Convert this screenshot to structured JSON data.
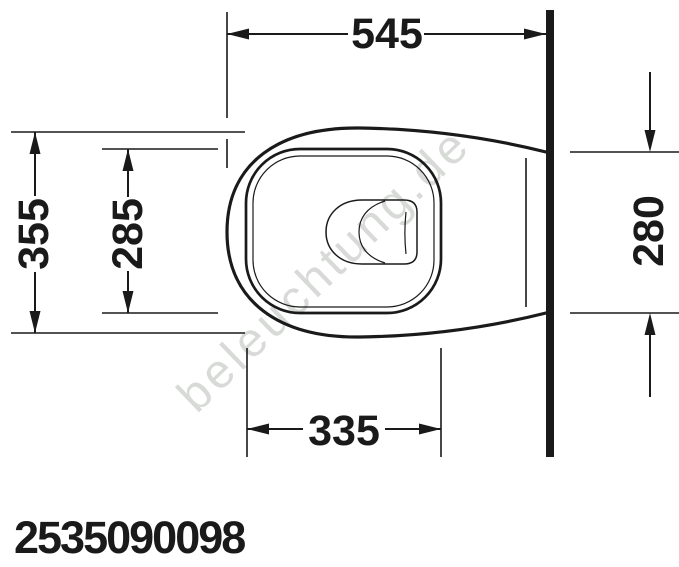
{
  "drawing": {
    "title": "wall-hung-toilet-top-view-technical-drawing",
    "watermark": "beleuchtung.de",
    "product_code": "2535090098",
    "dimensions": {
      "depth_total": "545",
      "width_total": "355",
      "seat_inner_width": "285",
      "rear_width": "280",
      "seat_inner_depth": "335"
    },
    "colors": {
      "line": "#1a1a1a",
      "watermark": "#d7dad7",
      "background": "#ffffff"
    }
  }
}
